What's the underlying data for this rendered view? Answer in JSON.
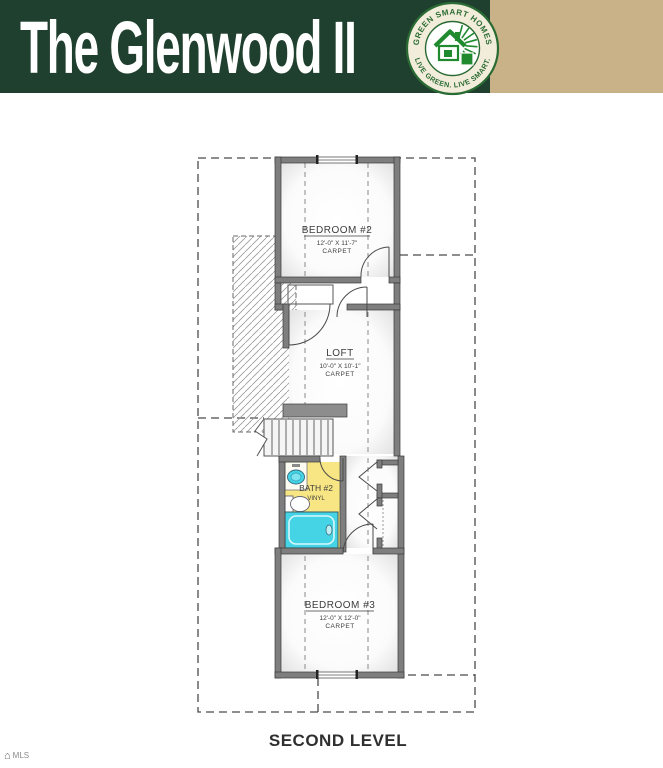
{
  "header": {
    "title": "The Glenwood II",
    "logo": {
      "arc_top": "GREEN SMART HOMES",
      "arc_bottom": "LIVE GREEN. LIVE SMART.",
      "icon": "green-house-logo"
    },
    "features": {
      "heading": "FEATURES:",
      "items": [
        "3 Bedroom",
        "2.5 Bath",
        "1,793 Square Feet"
      ]
    }
  },
  "plan": {
    "caption": "SECOND LEVEL",
    "rooms": {
      "bedroom2": {
        "name": "BEDROOM #2",
        "dims": "12'-0\" X 11'-7\"",
        "floor": "CARPET"
      },
      "loft": {
        "name": "LOFT",
        "dims": "10'-0\" X 10'-1\"",
        "floor": "CARPET"
      },
      "bath2": {
        "name": "BATH #2",
        "floor": "VINYL"
      },
      "bedroom3": {
        "name": "BEDROOM #3",
        "dims": "12'-0\" X 12'-0\"",
        "floor": "CARPET"
      }
    }
  },
  "watermark": {
    "text": "MLS"
  },
  "colors": {
    "header_green": "#20402f",
    "panel_tan": "#c9b287",
    "logo_green": "#1f8a2e",
    "bath_yellow": "#f7e683",
    "fixture_cyan": "#45d3e6",
    "line_gray": "#4a4a4a"
  }
}
